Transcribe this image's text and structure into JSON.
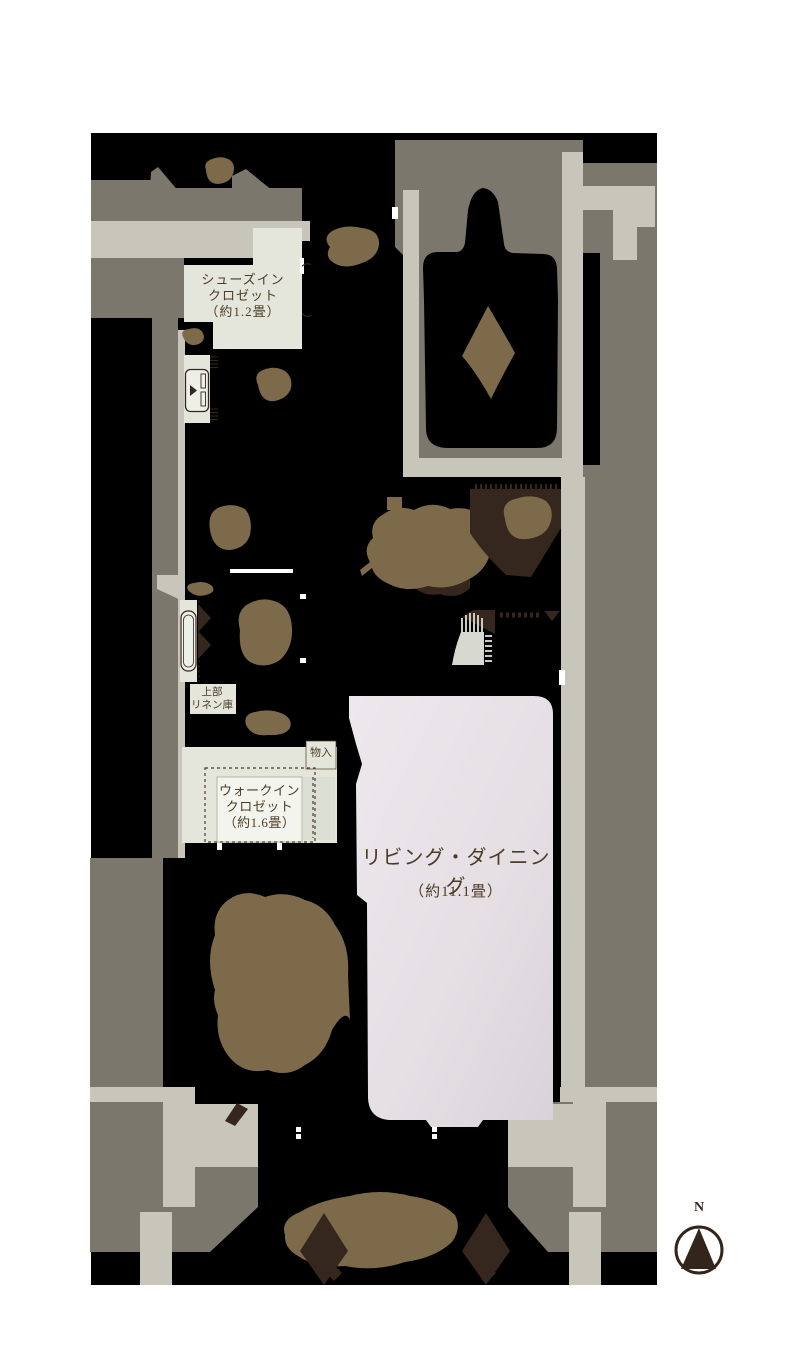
{
  "palette": {
    "page_bg": "#ffffff",
    "plan_bg": "#000000",
    "wall_dark": "#7b776d",
    "wall_light": "#c8c5bb",
    "closet": "#e4e6dc",
    "closet_dark": "#dcdfd3",
    "label_box": "#f3f4ed",
    "room": "#e2dce1",
    "room_light": "#ebe7eb",
    "plant": "#7d6a4a",
    "dark_brown": "#35261e",
    "fixture": "#eef0e8",
    "sink": "#d7d9d1",
    "text": "#4c3b27"
  },
  "rooms": {
    "shoes_closet": {
      "lines": [
        "シューズイン",
        "クロゼット",
        "（約1.2畳）"
      ]
    },
    "linen": {
      "lines": [
        "上部",
        "リネン庫"
      ]
    },
    "storage": {
      "label": "物入"
    },
    "walk_in_closet": {
      "lines": [
        "ウォークイン",
        "クロゼット",
        "（約1.6畳）"
      ]
    },
    "living_dining": {
      "name": "リビング・ダイニング",
      "size": "（約11.1畳）"
    }
  },
  "compass": {
    "label": "N"
  }
}
